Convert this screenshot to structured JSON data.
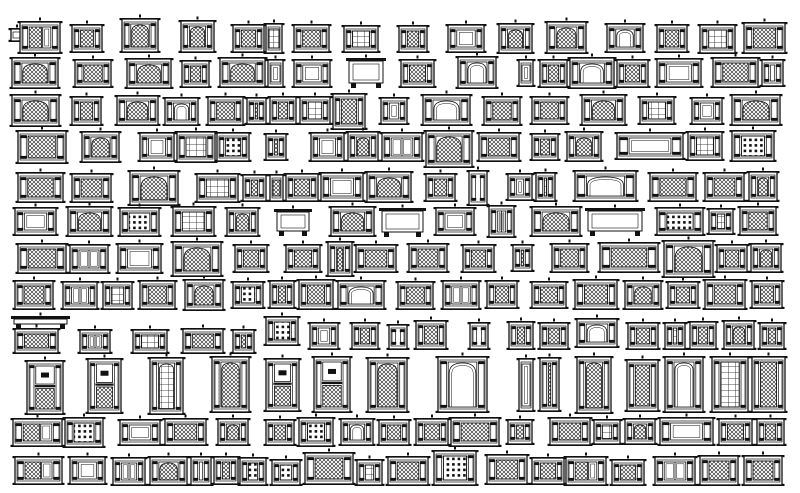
{
  "sheet": {
    "title": "cad-window-elevation-blocks-collection",
    "background": "#ffffff",
    "ink": "#111111",
    "variants": [
      "lattice",
      "arch-lattice",
      "white-panel",
      "grid-window",
      "coffer-dots",
      "double-door",
      "console",
      "lattice-door",
      "arch-white",
      "stacked-sash",
      "arch-grid"
    ],
    "blocks": [
      [
        11,
        28,
        12,
        14,
        0
      ],
      [
        20,
        21,
        40,
        33,
        7
      ],
      [
        72,
        24,
        30,
        29,
        0
      ],
      [
        122,
        18,
        36,
        35,
        1
      ],
      [
        181,
        20,
        33,
        33,
        1
      ],
      [
        233,
        24,
        31,
        29,
        0
      ],
      [
        266,
        23,
        16,
        31,
        3
      ],
      [
        294,
        24,
        35,
        29,
        0
      ],
      [
        344,
        25,
        34,
        28,
        3
      ],
      [
        399,
        25,
        28,
        28,
        0
      ],
      [
        448,
        24,
        36,
        29,
        2
      ],
      [
        499,
        23,
        33,
        31,
        1
      ],
      [
        547,
        21,
        39,
        33,
        1
      ],
      [
        607,
        23,
        36,
        30,
        8
      ],
      [
        657,
        24,
        30,
        29,
        0
      ],
      [
        700,
        24,
        35,
        30,
        3
      ],
      [
        744,
        22,
        41,
        32,
        0
      ],
      [
        12,
        57,
        46,
        32,
        1
      ],
      [
        75,
        59,
        36,
        29,
        0
      ],
      [
        127,
        58,
        44,
        31,
        1
      ],
      [
        182,
        60,
        27,
        28,
        0
      ],
      [
        220,
        57,
        45,
        31,
        1
      ],
      [
        268,
        59,
        15,
        29,
        2
      ],
      [
        294,
        59,
        36,
        29,
        2
      ],
      [
        348,
        58,
        36,
        30,
        6
      ],
      [
        401,
        59,
        33,
        29,
        0
      ],
      [
        458,
        56,
        38,
        33,
        8
      ],
      [
        519,
        59,
        14,
        28,
        2
      ],
      [
        540,
        59,
        27,
        29,
        0
      ],
      [
        570,
        57,
        44,
        32,
        8
      ],
      [
        617,
        59,
        31,
        29,
        0
      ],
      [
        657,
        58,
        44,
        30,
        2
      ],
      [
        713,
        57,
        45,
        31,
        0
      ],
      [
        762,
        59,
        21,
        28,
        2
      ],
      [
        12,
        94,
        47,
        33,
        1
      ],
      [
        72,
        96,
        29,
        30,
        0
      ],
      [
        117,
        95,
        41,
        31,
        1
      ],
      [
        165,
        97,
        33,
        29,
        8
      ],
      [
        208,
        96,
        35,
        30,
        0
      ],
      [
        247,
        97,
        19,
        28,
        0
      ],
      [
        270,
        96,
        26,
        29,
        0
      ],
      [
        300,
        96,
        30,
        29,
        3
      ],
      [
        333,
        93,
        32,
        37,
        0
      ],
      [
        381,
        97,
        26,
        28,
        2
      ],
      [
        423,
        94,
        47,
        32,
        8
      ],
      [
        484,
        96,
        36,
        30,
        0
      ],
      [
        532,
        96,
        35,
        29,
        0
      ],
      [
        582,
        94,
        43,
        32,
        1
      ],
      [
        640,
        96,
        34,
        29,
        3
      ],
      [
        692,
        97,
        30,
        28,
        2
      ],
      [
        732,
        94,
        48,
        32,
        1
      ],
      [
        18,
        130,
        48,
        34,
        0
      ],
      [
        82,
        131,
        37,
        32,
        1
      ],
      [
        140,
        132,
        34,
        30,
        2
      ],
      [
        177,
        131,
        38,
        32,
        3
      ],
      [
        217,
        132,
        32,
        30,
        4
      ],
      [
        266,
        133,
        20,
        28,
        0
      ],
      [
        311,
        132,
        33,
        30,
        2
      ],
      [
        348,
        131,
        30,
        31,
        1
      ],
      [
        382,
        132,
        40,
        30,
        5
      ],
      [
        426,
        130,
        46,
        38,
        1
      ],
      [
        479,
        132,
        40,
        30,
        0
      ],
      [
        532,
        133,
        26,
        28,
        0
      ],
      [
        567,
        131,
        34,
        31,
        1
      ],
      [
        617,
        132,
        66,
        28,
        2
      ],
      [
        688,
        131,
        34,
        30,
        3
      ],
      [
        732,
        130,
        42,
        32,
        4
      ],
      [
        18,
        172,
        45,
        31,
        0
      ],
      [
        72,
        173,
        39,
        30,
        0
      ],
      [
        130,
        170,
        48,
        36,
        1
      ],
      [
        197,
        173,
        41,
        30,
        3
      ],
      [
        243,
        174,
        23,
        28,
        0
      ],
      [
        270,
        174,
        13,
        28,
        0
      ],
      [
        286,
        173,
        32,
        29,
        0
      ],
      [
        321,
        172,
        42,
        30,
        2
      ],
      [
        367,
        171,
        44,
        32,
        1
      ],
      [
        426,
        173,
        29,
        29,
        0
      ],
      [
        469,
        170,
        18,
        36,
        0
      ],
      [
        508,
        173,
        24,
        28,
        2
      ],
      [
        536,
        172,
        19,
        30,
        3
      ],
      [
        575,
        170,
        61,
        32,
        8
      ],
      [
        650,
        172,
        46,
        30,
        0
      ],
      [
        705,
        172,
        39,
        30,
        0
      ],
      [
        749,
        171,
        28,
        31,
        1
      ],
      [
        15,
        207,
        41,
        29,
        2
      ],
      [
        68,
        206,
        43,
        31,
        1
      ],
      [
        120,
        207,
        39,
        30,
        4
      ],
      [
        173,
        206,
        41,
        31,
        3
      ],
      [
        227,
        207,
        31,
        30,
        1
      ],
      [
        276,
        209,
        34,
        27,
        6
      ],
      [
        331,
        206,
        43,
        31,
        1
      ],
      [
        381,
        208,
        43,
        29,
        6
      ],
      [
        436,
        207,
        38,
        29,
        2
      ],
      [
        489,
        205,
        25,
        33,
        5
      ],
      [
        532,
        206,
        48,
        31,
        1
      ],
      [
        587,
        208,
        56,
        28,
        6
      ],
      [
        657,
        207,
        46,
        29,
        4
      ],
      [
        709,
        208,
        24,
        27,
        3
      ],
      [
        740,
        206,
        36,
        30,
        0
      ],
      [
        18,
        243,
        48,
        31,
        0
      ],
      [
        70,
        244,
        38,
        30,
        5
      ],
      [
        118,
        243,
        43,
        31,
        2
      ],
      [
        173,
        241,
        48,
        36,
        1
      ],
      [
        235,
        244,
        32,
        29,
        0
      ],
      [
        286,
        244,
        34,
        29,
        0
      ],
      [
        328,
        241,
        24,
        36,
        1
      ],
      [
        356,
        244,
        40,
        29,
        0
      ],
      [
        409,
        243,
        38,
        30,
        0
      ],
      [
        463,
        244,
        31,
        29,
        0
      ],
      [
        513,
        244,
        19,
        28,
        0
      ],
      [
        552,
        243,
        35,
        30,
        0
      ],
      [
        600,
        242,
        58,
        31,
        0
      ],
      [
        664,
        240,
        49,
        38,
        1
      ],
      [
        717,
        244,
        30,
        29,
        0
      ],
      [
        751,
        243,
        30,
        30,
        1
      ],
      [
        15,
        280,
        38,
        30,
        0
      ],
      [
        63,
        281,
        34,
        29,
        5
      ],
      [
        103,
        281,
        29,
        29,
        3
      ],
      [
        140,
        280,
        35,
        30,
        0
      ],
      [
        185,
        279,
        38,
        32,
        1
      ],
      [
        233,
        281,
        30,
        28,
        4
      ],
      [
        270,
        280,
        24,
        29,
        0
      ],
      [
        299,
        279,
        34,
        31,
        0
      ],
      [
        338,
        280,
        46,
        30,
        8
      ],
      [
        398,
        281,
        35,
        29,
        0
      ],
      [
        443,
        280,
        36,
        30,
        5
      ],
      [
        487,
        280,
        30,
        29,
        0
      ],
      [
        532,
        281,
        34,
        28,
        0
      ],
      [
        575,
        279,
        42,
        31,
        0
      ],
      [
        625,
        280,
        36,
        30,
        1
      ],
      [
        668,
        281,
        30,
        28,
        0
      ],
      [
        705,
        279,
        40,
        31,
        0
      ],
      [
        752,
        280,
        30,
        29,
        0
      ],
      [
        13,
        316,
        55,
        13,
        6
      ],
      [
        15,
        328,
        43,
        26,
        0
      ],
      [
        80,
        329,
        30,
        25,
        5
      ],
      [
        133,
        329,
        34,
        25,
        3
      ],
      [
        183,
        328,
        40,
        26,
        0
      ],
      [
        233,
        329,
        21,
        25,
        0
      ],
      [
        266,
        316,
        32,
        30,
        4
      ],
      [
        310,
        322,
        28,
        28,
        2
      ],
      [
        352,
        322,
        26,
        28,
        0
      ],
      [
        389,
        324,
        18,
        26,
        0
      ],
      [
        416,
        320,
        30,
        30,
        0
      ],
      [
        470,
        322,
        18,
        28,
        2
      ],
      [
        509,
        321,
        24,
        29,
        0
      ],
      [
        540,
        322,
        28,
        28,
        0
      ],
      [
        577,
        318,
        40,
        30,
        8
      ],
      [
        628,
        322,
        30,
        28,
        0
      ],
      [
        665,
        322,
        20,
        28,
        3
      ],
      [
        690,
        321,
        26,
        29,
        0
      ],
      [
        724,
        320,
        30,
        30,
        1
      ],
      [
        760,
        322,
        24,
        28,
        0
      ],
      [
        27,
        360,
        36,
        55,
        9
      ],
      [
        88,
        358,
        33,
        56,
        9
      ],
      [
        150,
        357,
        33,
        58,
        10
      ],
      [
        212,
        356,
        37,
        57,
        1
      ],
      [
        266,
        358,
        33,
        54,
        9
      ],
      [
        314,
        356,
        36,
        57,
        9
      ],
      [
        368,
        357,
        39,
        56,
        1
      ],
      [
        438,
        356,
        49,
        57,
        8
      ],
      [
        519,
        358,
        14,
        54,
        2
      ],
      [
        540,
        357,
        19,
        55,
        0
      ],
      [
        577,
        356,
        34,
        58,
        1
      ],
      [
        627,
        359,
        31,
        53,
        0
      ],
      [
        665,
        356,
        38,
        57,
        8
      ],
      [
        712,
        356,
        36,
        57,
        3
      ],
      [
        752,
        356,
        33,
        57,
        0
      ],
      [
        13,
        418,
        49,
        29,
        7
      ],
      [
        65,
        417,
        38,
        31,
        4
      ],
      [
        120,
        419,
        40,
        27,
        2
      ],
      [
        165,
        418,
        41,
        28,
        0
      ],
      [
        218,
        418,
        30,
        28,
        1
      ],
      [
        266,
        419,
        28,
        27,
        0
      ],
      [
        299,
        417,
        34,
        30,
        4
      ],
      [
        341,
        418,
        32,
        28,
        8
      ],
      [
        379,
        419,
        30,
        27,
        0
      ],
      [
        416,
        418,
        32,
        28,
        0
      ],
      [
        451,
        417,
        48,
        30,
        0
      ],
      [
        508,
        419,
        24,
        26,
        0
      ],
      [
        550,
        417,
        40,
        29,
        0
      ],
      [
        594,
        419,
        26,
        26,
        3
      ],
      [
        625,
        418,
        30,
        27,
        1
      ],
      [
        660,
        417,
        53,
        29,
        2
      ],
      [
        719,
        418,
        33,
        28,
        0
      ],
      [
        757,
        418,
        27,
        28,
        0
      ],
      [
        15,
        456,
        47,
        29,
        7
      ],
      [
        70,
        456,
        35,
        29,
        2
      ],
      [
        113,
        457,
        32,
        29,
        5
      ],
      [
        150,
        456,
        37,
        30,
        1
      ],
      [
        191,
        456,
        20,
        30,
        2
      ],
      [
        214,
        456,
        24,
        29,
        0
      ],
      [
        240,
        457,
        26,
        29,
        4
      ],
      [
        272,
        459,
        28,
        27,
        4
      ],
      [
        305,
        452,
        48,
        33,
        0
      ],
      [
        357,
        459,
        25,
        27,
        3
      ],
      [
        388,
        456,
        40,
        30,
        0
      ],
      [
        434,
        450,
        42,
        36,
        4
      ],
      [
        487,
        454,
        40,
        31,
        0
      ],
      [
        532,
        457,
        32,
        28,
        0
      ],
      [
        566,
        456,
        40,
        30,
        7
      ],
      [
        612,
        459,
        32,
        27,
        0
      ],
      [
        655,
        456,
        40,
        30,
        5
      ],
      [
        700,
        455,
        38,
        31,
        0
      ],
      [
        744,
        455,
        38,
        31,
        0
      ]
    ]
  }
}
